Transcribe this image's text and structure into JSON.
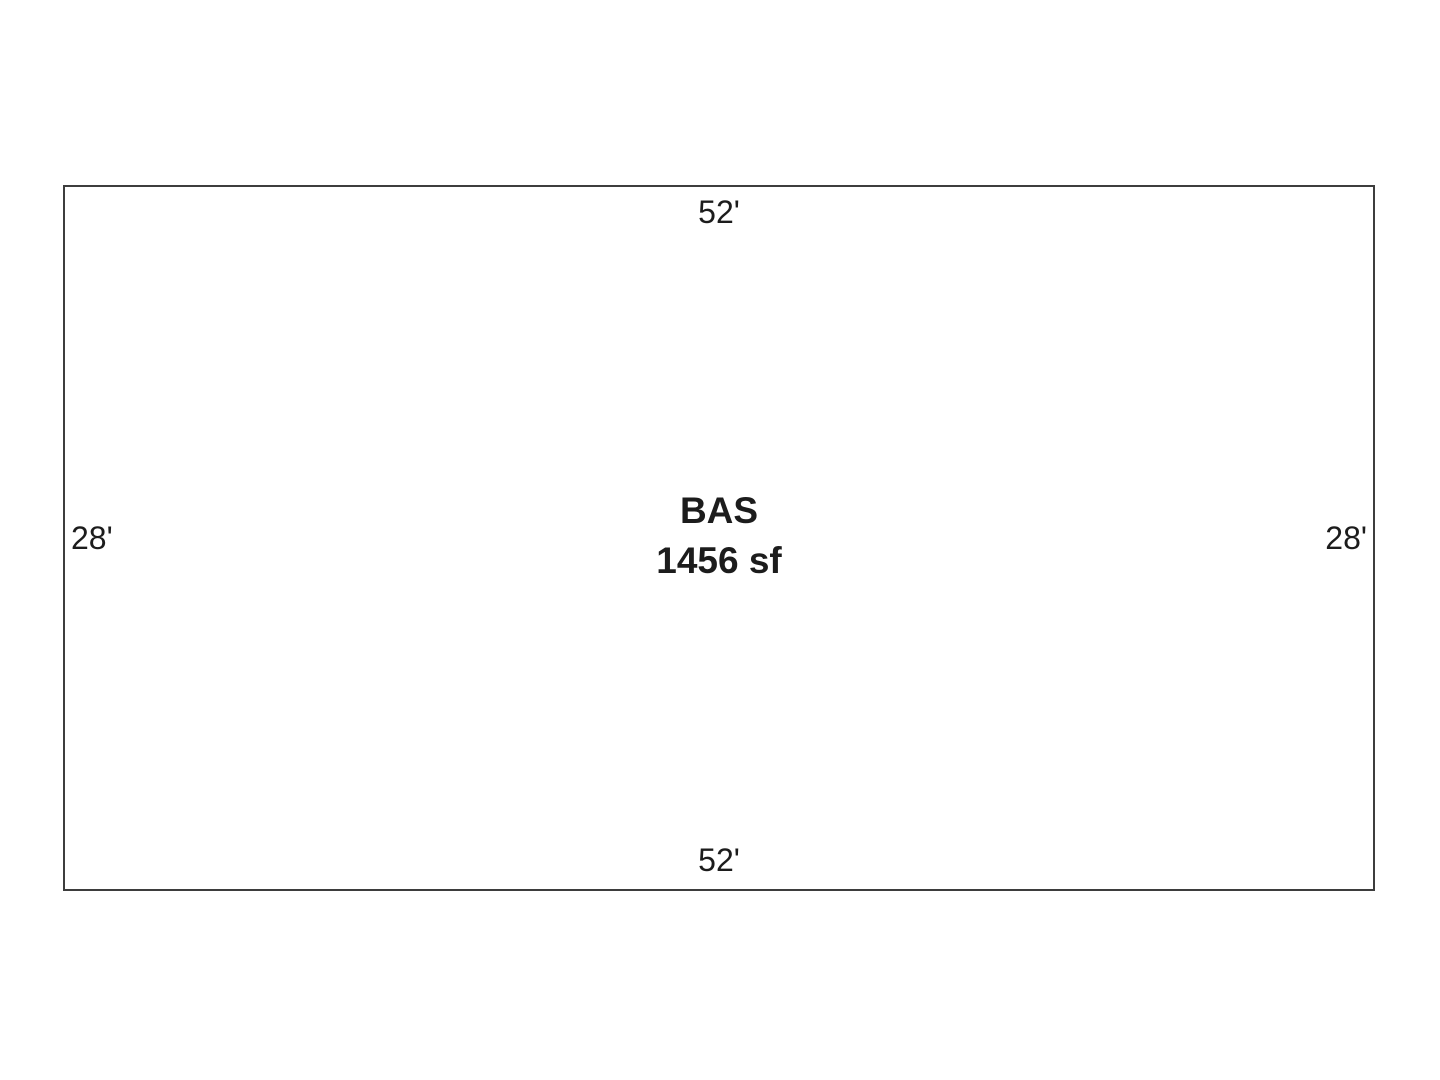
{
  "page": {
    "background": "#ffffff"
  },
  "sketch": {
    "outline_color": "#3d3d3d",
    "text_color": "#1c1c1c",
    "area": {
      "code": "BAS",
      "size": "1456 sf"
    },
    "dimensions": {
      "top": "52'",
      "bottom": "52'",
      "left": "28'",
      "right": "28'"
    }
  }
}
